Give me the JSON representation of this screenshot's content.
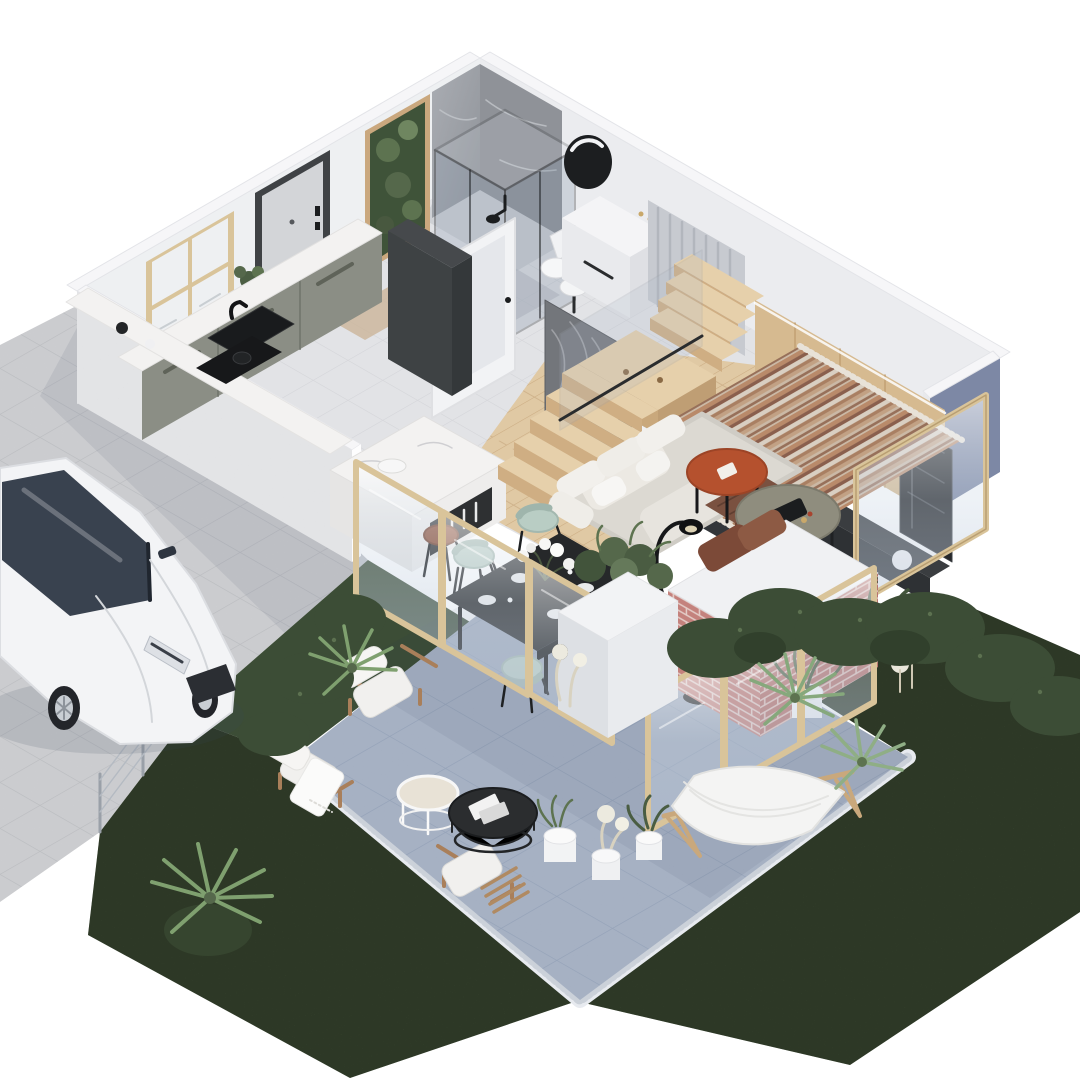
{
  "scene": {
    "type": "3d-isometric-cutaway-floor-plan-render",
    "areas": [
      {
        "name": "bathroom",
        "objects": [
          "marble-corner-walls",
          "glass-shower-cabin",
          "round-mirror",
          "toilet",
          "washbasin",
          "white-utility-cabinet",
          "print-feature-panel"
        ]
      },
      {
        "name": "entry-hall",
        "objects": [
          "front-door",
          "frosted-interior-door",
          "tall-charcoal-cabinet",
          "doormat"
        ]
      },
      {
        "name": "kitchen",
        "objects": [
          "window",
          "marble-counter",
          "black-sink",
          "sage-cabinets",
          "cooktop",
          "marble-island",
          "leather-bar-stools",
          "potted-plant"
        ]
      },
      {
        "name": "staircase",
        "objects": [
          "wood-winder-stairs",
          "glass-railing",
          "slat-wall",
          "under-stair-bookshelf"
        ]
      },
      {
        "name": "living-room",
        "objects": [
          "wood-tv-wall",
          "tv",
          "media-bench",
          "display-cabinet",
          "corner-sofa",
          "striped-rug",
          "terracotta-coffee-table",
          "olive-coffee-table",
          "arc-floor-lamp",
          "brick-planter",
          "brown-cushions"
        ]
      },
      {
        "name": "dining-area",
        "objects": [
          "black-dining-table",
          "mint-chairs",
          "flower-centerpiece",
          "folding-glass-doors",
          "white-planter-pillar"
        ]
      },
      {
        "name": "patio-terrace",
        "objects": [
          "blue-stone-tiles",
          "gravel-border",
          "wood-armchairs",
          "nesting-coffee-tables",
          "hammock-lounger",
          "potted-plants",
          "pampas-grass"
        ]
      },
      {
        "name": "garden",
        "objects": [
          "lawn",
          "bushes",
          "palms"
        ]
      },
      {
        "name": "driveway",
        "objects": [
          "paver-floor",
          "white-hatchback-car",
          "wire-fence"
        ]
      }
    ]
  },
  "palette": {
    "background": "#ffffff",
    "grass": "#46573b",
    "bush": "#3c4d36",
    "palm": "#86a87c",
    "patio_tile": "#9aa6bb",
    "patio_line": "#8696af",
    "gravel": "#e7eaef",
    "pavers": "#d7d8db",
    "paver_line": "#c6c8cc",
    "wall_top": "#f6f6f8",
    "wall_interior": "#ebecef",
    "wall_interior2": "#eef0f2",
    "wall_exterior": "#d5d6d9",
    "wall_blue": "#7d88a5",
    "floor_tile": "#e2e3e6",
    "floor_tile_line": "#d3d4d8",
    "wood_floor": "#e0c9a4",
    "wood_floor_line": "#cbab81",
    "stair_wood": "#e6d0ab",
    "stair_wood_side": "#cfae83",
    "tv_wall_wood": "#d6ba90",
    "marble": "#f3f2f1",
    "bath_marble": "#9fa3a9",
    "cabinet_sage": "#8b8e85",
    "cabinet_charcoal": "#3e4244",
    "sofa": "#dcd9d2",
    "sofa_cushion": "#ece9e3",
    "rug_base": "#cbb9a6",
    "rug_rust": "#b98a6a",
    "rug_brown": "#8a5f4d",
    "rug_cream": "#d9cfc2",
    "terracotta": "#b5512e",
    "olive_table": "#8f8d7e",
    "mint_chair": "#b9cdc4",
    "dining_table": "#26282a",
    "brick": "#c4827d",
    "brick_mortar": "#e3cbc6",
    "glass_frame_wood": "#d9c49a",
    "car": "#f3f4f6",
    "car_glass": "#39424f",
    "black": "#1b1d1f",
    "throw_brown": "#7a5140",
    "stool_leather": "#8a4a32"
  }
}
